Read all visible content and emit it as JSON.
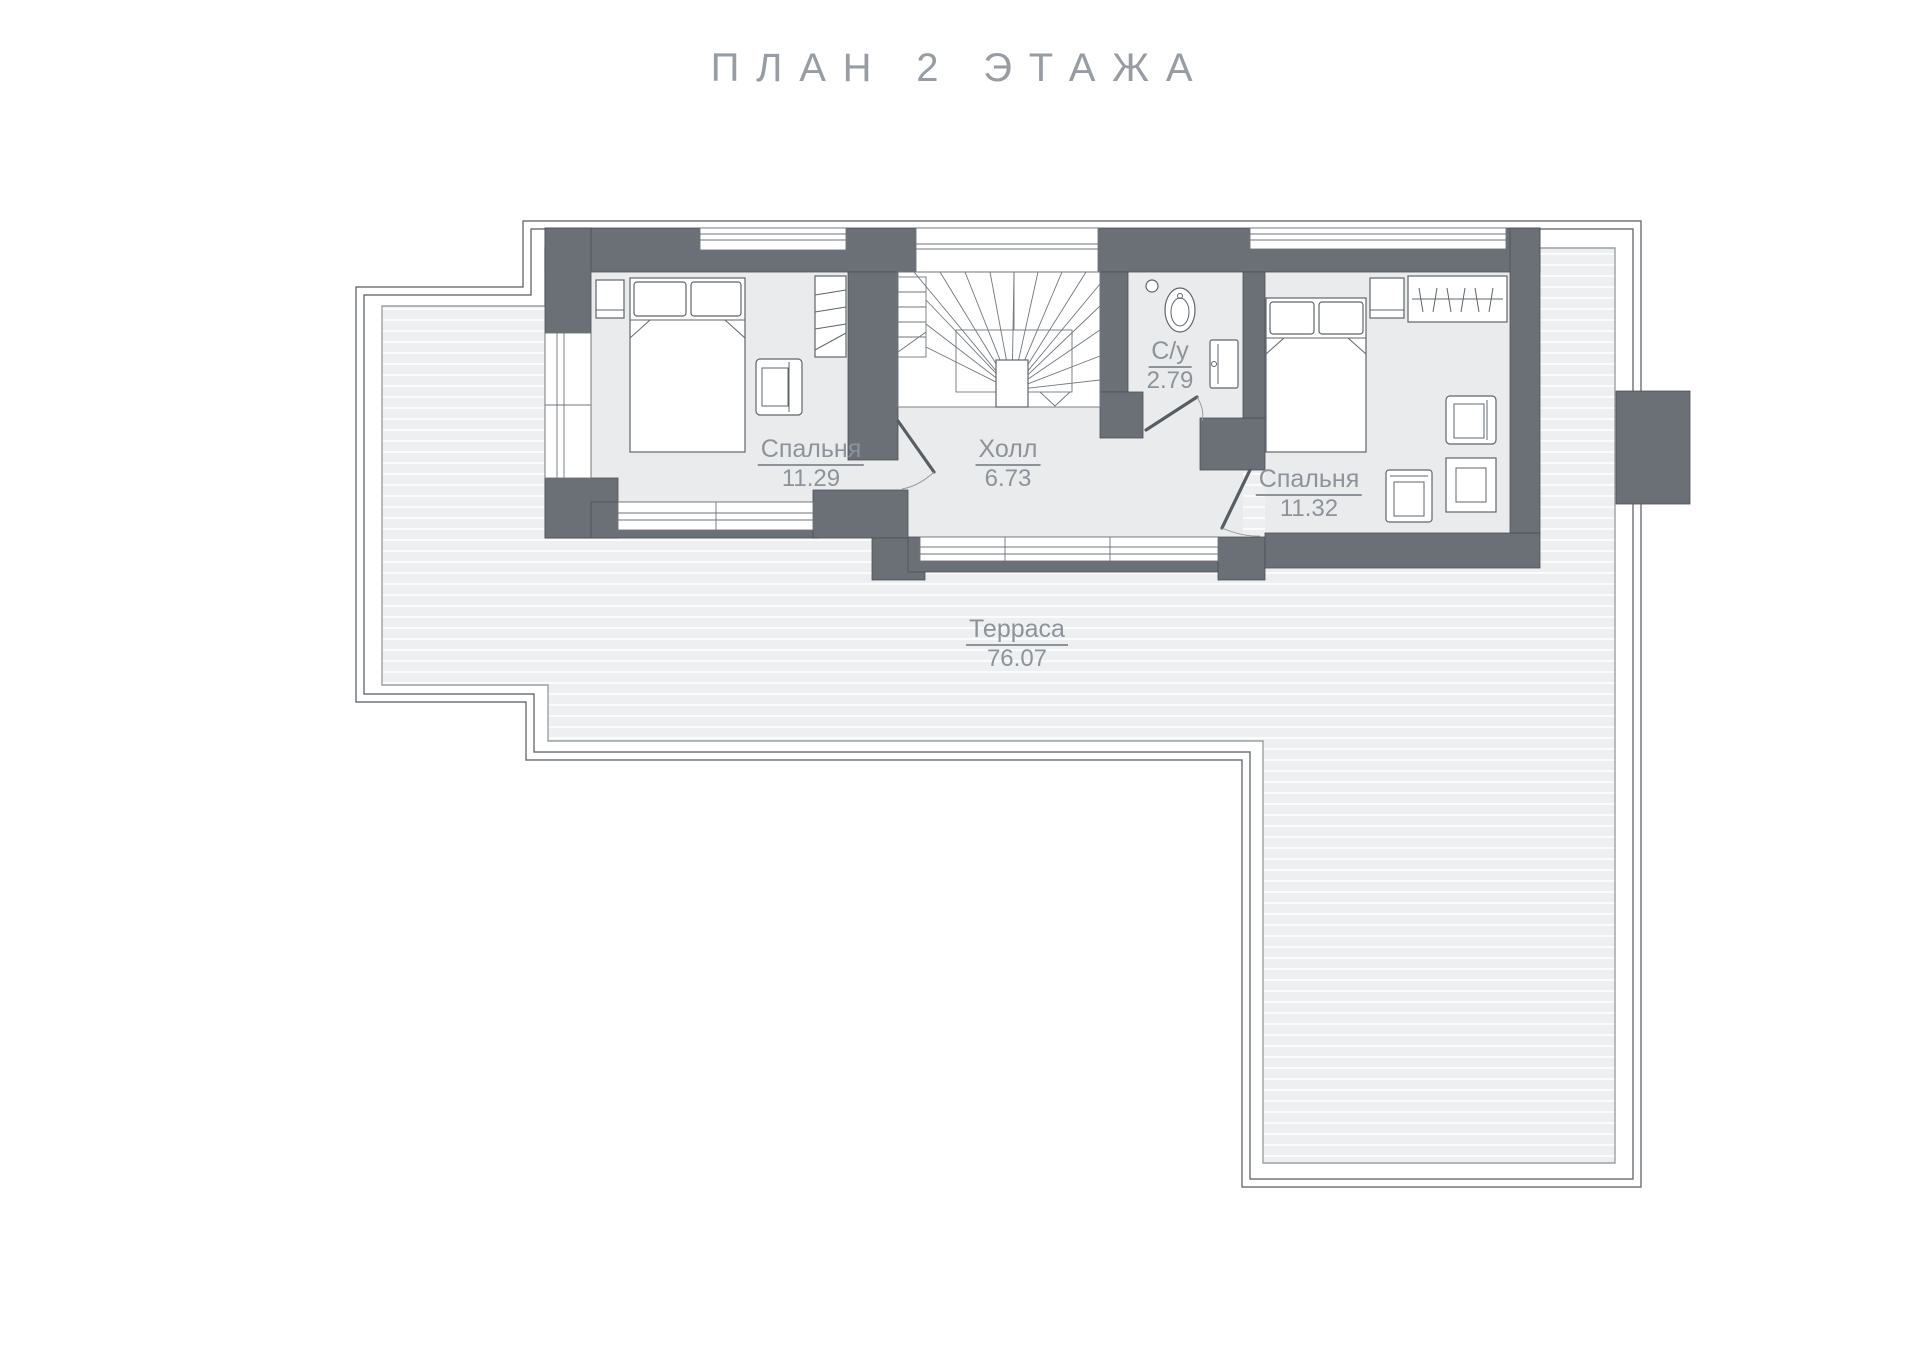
{
  "title": "ПЛАН 2 ЭТАЖА",
  "rooms": [
    {
      "id": "bedroom-1",
      "name": "Спальня",
      "area": "11.29"
    },
    {
      "id": "hall",
      "name": "Холл",
      "area": "6.73"
    },
    {
      "id": "bathroom",
      "name": "С/у",
      "area": "2.79"
    },
    {
      "id": "bedroom-2",
      "name": "Спальня",
      "area": "11.32"
    },
    {
      "id": "terrace",
      "name": "Терраса",
      "area": "76.07"
    }
  ],
  "colors": {
    "wall": "#6A7076",
    "deck": "#EDEFF0",
    "deck_line": "#FAFBFB",
    "floor": "#E9EBEC",
    "border": "#53595F",
    "label": "#8D939A",
    "furniture": "#5F666C",
    "title": "#979DA2"
  }
}
